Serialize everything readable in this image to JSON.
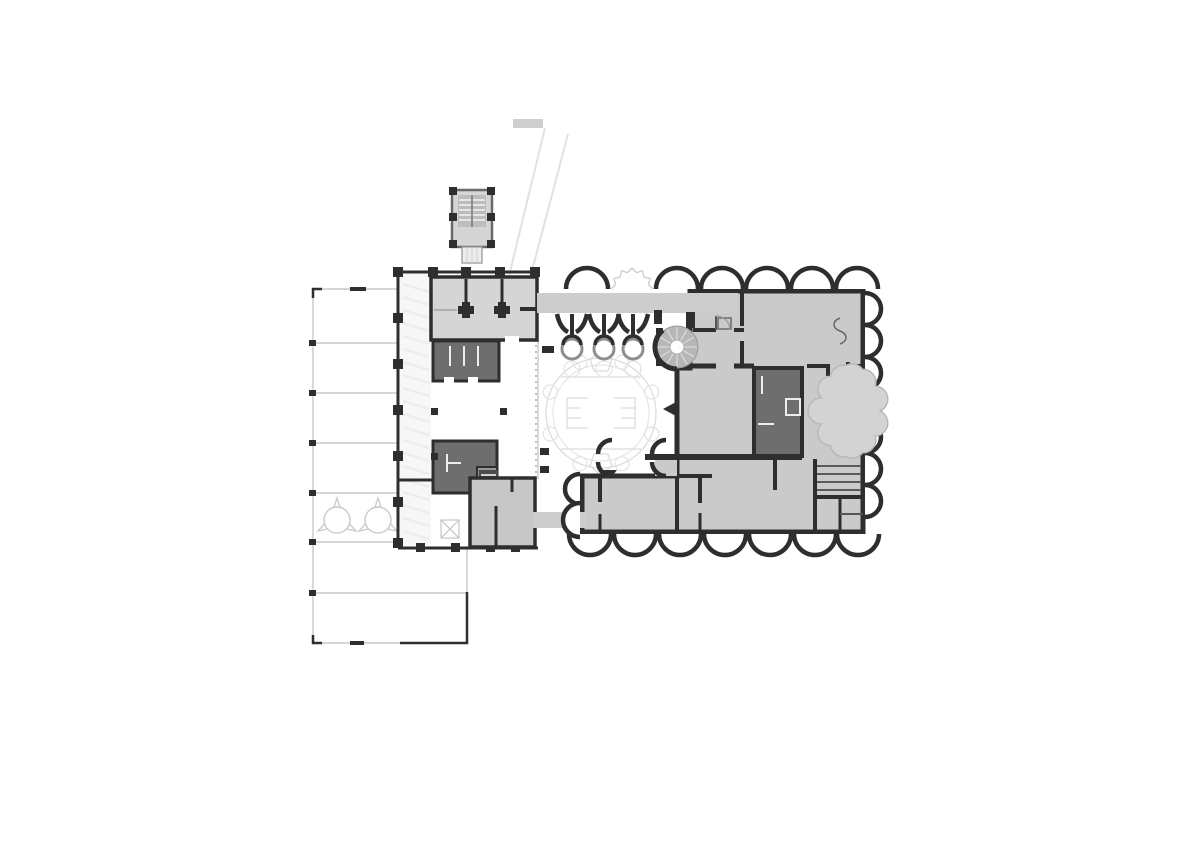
{
  "palette": {
    "wall": "#2e2e2e",
    "room_light": "#d5d5d5",
    "room_mid": "#c7c7c7",
    "room_dark": "#6e6e6e",
    "room_meddark": "#979797",
    "building": "#cacaca",
    "walkway": "#cdcdcd",
    "ghost": "#dcdcdc",
    "ghost_strong": "#c9c9c9",
    "stair_fill": "#b7b7b7",
    "tread": "#5a5a5a",
    "dash_line": "#9f9f9f"
  },
  "canopy": {
    "left": 313,
    "top": 289,
    "bottom": 643,
    "grid_line_ys": [
      343,
      393,
      443,
      493,
      542
    ],
    "long_line_y": 593,
    "line_x_end": 398,
    "long_line_x_end": 467,
    "dark_corner": {
      "x1": 400,
      "x2": 467,
      "y_bottom": 643,
      "y_up": 592
    },
    "trees": [
      {
        "cx": 337,
        "cy": 520
      },
      {
        "cx": 378,
        "cy": 520
      }
    ],
    "tree_radius": 13
  },
  "corridor_hatch": {
    "x1": 403,
    "x2": 429,
    "y_start": 284,
    "y_end": 538,
    "step": 13
  },
  "diagonal_path": {
    "lines": [
      [
        545,
        128,
        508,
        280
      ],
      [
        568,
        134,
        529,
        282
      ]
    ],
    "cap_rect": [
      513,
      119,
      30,
      9
    ]
  },
  "fountain": {
    "cx": 601,
    "cy": 413,
    "outer_r": 55,
    "inner_r": 48,
    "bump_r": 7,
    "bump_count": 8,
    "bump_start_deg": 22.5,
    "chord_top_y": 377,
    "chord_bottom_y": 449,
    "chord_x1": 561,
    "chord_x2": 641
  },
  "arcade": {
    "arch_radius": 21,
    "top": {
      "base_y": 289,
      "centers_x": [
        587,
        677,
        722,
        767,
        812,
        857
      ],
      "ghost_center_x": 632
    },
    "right": {
      "base_x": 865,
      "centers_y": [
        309,
        341,
        373,
        405,
        437,
        469,
        501
      ],
      "radius": 16
    },
    "bottom": {
      "base_y": 534,
      "centers_x": [
        590,
        635,
        680,
        725,
        770,
        815,
        858
      ]
    },
    "left": {
      "base_x": 580,
      "arches": [
        {
          "cy": 489,
          "r": 15
        },
        {
          "cy": 520,
          "r": 17
        }
      ]
    }
  },
  "ornament_columns": {
    "centers_x": [
      572,
      604,
      633
    ],
    "top_y": 314,
    "ring_cy": 349,
    "ring_r": 10,
    "ghost_cy": 369,
    "ghost_r": 8
  },
  "spiral_stair": {
    "cx": 677,
    "cy": 347,
    "r": 21,
    "hub_r": 7,
    "tread_count": 12,
    "dark_arc": {
      "r": 22,
      "from_deg": 90,
      "to_deg": 230
    }
  },
  "garden_blob": {
    "cx": 850,
    "cy": 411,
    "rx": 30,
    "ry": 46,
    "bump_count": 11,
    "bump_r": 13
  }
}
